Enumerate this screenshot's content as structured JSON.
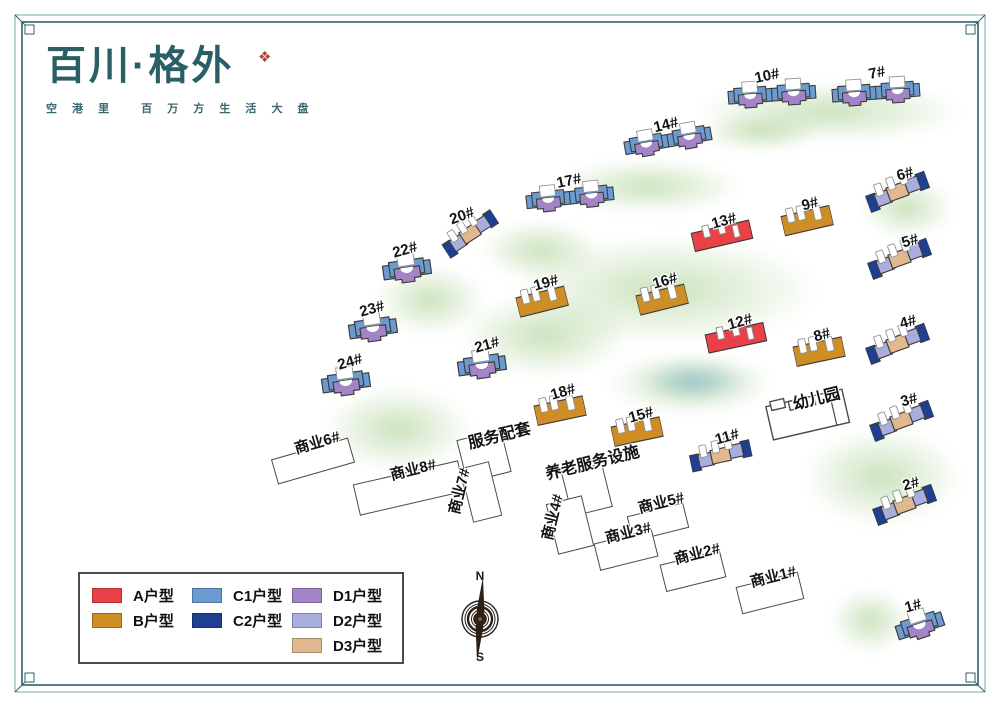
{
  "page": {
    "frame_outer": "#74a5a4",
    "frame_inner": "#2f6068"
  },
  "logo": {
    "title": "百川·格外",
    "seal_glyph": "❖",
    "tagline": "空 港 里　 百 万 方 生 活 大 盘"
  },
  "colors": {
    "A": "#ea4147",
    "B": "#ce8e25",
    "C1": "#6c9bd2",
    "C2": "#1e3f92",
    "D1": "#a385c7",
    "D2": "#a9aede",
    "D3": "#e2b88e"
  },
  "legend": {
    "items": [
      {
        "key": "A",
        "label": "A户型"
      },
      {
        "key": "B",
        "label": "B户型"
      },
      {
        "key": "C1",
        "label": "C1户型"
      },
      {
        "key": "C2",
        "label": "C2户型"
      },
      {
        "key": "D1",
        "label": "D1户型"
      },
      {
        "key": "D2",
        "label": "D2户型"
      },
      {
        "key": "D3",
        "label": "D3户型"
      }
    ],
    "columns": [
      [
        0,
        1
      ],
      [
        2,
        3
      ],
      [
        4,
        5,
        6
      ]
    ]
  },
  "compass": {
    "north": "N",
    "south": "S"
  },
  "blob_colors": {
    "g": "rgba(151,199,123,0.5)",
    "b": "rgba(125,180,205,0.6)"
  },
  "blobs": [
    {
      "x": 830,
      "y": 112,
      "w": 270,
      "h": 60,
      "c": "g"
    },
    {
      "x": 760,
      "y": 132,
      "w": 120,
      "h": 40,
      "c": "g"
    },
    {
      "x": 648,
      "y": 186,
      "w": 190,
      "h": 55,
      "c": "g"
    },
    {
      "x": 906,
      "y": 208,
      "w": 95,
      "h": 60,
      "c": "g"
    },
    {
      "x": 665,
      "y": 290,
      "w": 310,
      "h": 110,
      "c": "g"
    },
    {
      "x": 540,
      "y": 250,
      "w": 120,
      "h": 60,
      "c": "g"
    },
    {
      "x": 545,
      "y": 335,
      "w": 170,
      "h": 85,
      "c": "g"
    },
    {
      "x": 430,
      "y": 300,
      "w": 110,
      "h": 70,
      "c": "g"
    },
    {
      "x": 398,
      "y": 428,
      "w": 150,
      "h": 85,
      "c": "g"
    },
    {
      "x": 690,
      "y": 383,
      "w": 170,
      "h": 65,
      "c": "g"
    },
    {
      "x": 695,
      "y": 381,
      "w": 110,
      "h": 42,
      "c": "b"
    },
    {
      "x": 882,
      "y": 477,
      "w": 160,
      "h": 100,
      "c": "g"
    },
    {
      "x": 870,
      "y": 620,
      "w": 80,
      "h": 65,
      "c": "g"
    }
  ],
  "buildings": [
    {
      "id": "10",
      "t": "double",
      "x": 772,
      "y": 95,
      "r": -4,
      "lbl": {
        "t": "10#",
        "x": 767,
        "y": 76,
        "r": -12
      }
    },
    {
      "id": "7",
      "t": "double",
      "x": 876,
      "y": 93,
      "r": -4,
      "lbl": {
        "t": "7#",
        "x": 877,
        "y": 73,
        "r": -12
      }
    },
    {
      "id": "14",
      "t": "double",
      "x": 668,
      "y": 141,
      "r": -10,
      "lbl": {
        "t": "14#",
        "x": 666,
        "y": 125,
        "r": -14
      }
    },
    {
      "id": "17",
      "t": "double",
      "x": 570,
      "y": 198,
      "r": -6,
      "lbl": {
        "t": "17#",
        "x": 569,
        "y": 181,
        "r": -12
      }
    },
    {
      "id": "20",
      "t": "slabC",
      "x": 471,
      "y": 235,
      "r": -33,
      "w": 60,
      "h": 30,
      "lbl": {
        "t": "20#",
        "x": 462,
        "y": 216,
        "r": -20
      }
    },
    {
      "id": "22",
      "t": "unit",
      "x": 407,
      "y": 270,
      "r": -8,
      "lbl": {
        "t": "22#",
        "x": 405,
        "y": 250,
        "r": -16
      }
    },
    {
      "id": "23",
      "t": "unit",
      "x": 373,
      "y": 329,
      "r": -8,
      "lbl": {
        "t": "23#",
        "x": 372,
        "y": 309,
        "r": -16
      }
    },
    {
      "id": "24",
      "t": "unit",
      "x": 346,
      "y": 383,
      "r": -8,
      "lbl": {
        "t": "24#",
        "x": 350,
        "y": 362,
        "r": -16
      }
    },
    {
      "id": "21",
      "t": "unit",
      "x": 482,
      "y": 366,
      "r": -8,
      "lbl": {
        "t": "21#",
        "x": 487,
        "y": 345,
        "r": -16
      }
    },
    {
      "id": "19",
      "t": "slabB",
      "x": 542,
      "y": 301,
      "r": -14,
      "lbl": {
        "t": "19#",
        "x": 546,
        "y": 283,
        "r": -16
      }
    },
    {
      "id": "16",
      "t": "slabB",
      "x": 662,
      "y": 299,
      "r": -14,
      "lbl": {
        "t": "16#",
        "x": 665,
        "y": 281,
        "r": -16
      }
    },
    {
      "id": "13",
      "t": "slabA",
      "x": 722,
      "y": 236,
      "r": -13,
      "lbl": {
        "t": "13#",
        "x": 724,
        "y": 221,
        "r": -16
      }
    },
    {
      "id": "9",
      "t": "slabB",
      "x": 807,
      "y": 220,
      "r": -13,
      "lbl": {
        "t": "9#",
        "x": 810,
        "y": 204,
        "r": -16
      }
    },
    {
      "id": "12",
      "t": "slabA",
      "x": 736,
      "y": 338,
      "r": -12,
      "lbl": {
        "t": "12#",
        "x": 740,
        "y": 322,
        "r": -16
      }
    },
    {
      "id": "8",
      "t": "slabB",
      "x": 819,
      "y": 351,
      "r": -12,
      "lbl": {
        "t": "8#",
        "x": 822,
        "y": 335,
        "r": -16
      }
    },
    {
      "id": "18",
      "t": "slabB",
      "x": 560,
      "y": 410,
      "r": -12,
      "lbl": {
        "t": "18#",
        "x": 563,
        "y": 392,
        "r": -16
      }
    },
    {
      "id": "15",
      "t": "slabB",
      "x": 637,
      "y": 431,
      "r": -12,
      "lbl": {
        "t": "15#",
        "x": 641,
        "y": 415,
        "r": -16
      }
    },
    {
      "id": "11",
      "t": "slabC",
      "x": 721,
      "y": 457,
      "r": -12,
      "w": 62,
      "h": 32,
      "lbl": {
        "t": "11#",
        "x": 727,
        "y": 437,
        "r": -16
      }
    },
    {
      "id": "6",
      "t": "slabC",
      "x": 898,
      "y": 193,
      "r": -20,
      "lbl": {
        "t": "6#",
        "x": 905,
        "y": 174,
        "r": -16
      }
    },
    {
      "id": "5",
      "t": "slabC",
      "x": 900,
      "y": 260,
      "r": -20,
      "lbl": {
        "t": "5#",
        "x": 910,
        "y": 241,
        "r": -16
      }
    },
    {
      "id": "4",
      "t": "slabC",
      "x": 898,
      "y": 345,
      "r": -20,
      "lbl": {
        "t": "4#",
        "x": 908,
        "y": 322,
        "r": -16
      }
    },
    {
      "id": "3",
      "t": "slabC",
      "x": 902,
      "y": 422,
      "r": -20,
      "lbl": {
        "t": "3#",
        "x": 909,
        "y": 400,
        "r": -16
      }
    },
    {
      "id": "2",
      "t": "slabC",
      "x": 905,
      "y": 506,
      "r": -20,
      "lbl": {
        "t": "2#",
        "x": 911,
        "y": 484,
        "r": -16
      }
    },
    {
      "id": "1",
      "t": "unit",
      "x": 920,
      "y": 626,
      "r": -18,
      "lbl": {
        "t": "1#",
        "x": 913,
        "y": 606,
        "r": -16
      }
    },
    {
      "id": "kg",
      "t": "kg",
      "x": 808,
      "y": 416,
      "r": -13,
      "lbl": {
        "t": "幼儿园",
        "x": 816,
        "y": 397,
        "r": -14,
        "big": true
      }
    },
    {
      "id": "sy6",
      "t": "white",
      "w": 80,
      "h": 26,
      "x": 313,
      "y": 461,
      "r": -16,
      "lbl": {
        "t": "商业6#",
        "x": 317,
        "y": 442,
        "r": -16
      }
    },
    {
      "id": "sy8",
      "t": "white",
      "w": 108,
      "h": 32,
      "x": 409,
      "y": 488,
      "r": -13,
      "lbl": {
        "t": "商业8#",
        "x": 413,
        "y": 469,
        "r": -14
      }
    },
    {
      "id": "fwpt",
      "t": "white",
      "w": 46,
      "h": 44,
      "x": 484,
      "y": 456,
      "r": -14,
      "lbl": {
        "t": "服务配套",
        "x": 499,
        "y": 434,
        "r": -14,
        "big": true
      }
    },
    {
      "id": "sy7",
      "t": "white",
      "w": 30,
      "h": 56,
      "x": 481,
      "y": 492,
      "r": -14,
      "lbl": {
        "t": "商业7#",
        "x": 459,
        "y": 491,
        "r": -76
      }
    },
    {
      "id": "ylfw",
      "t": "white",
      "w": 42,
      "h": 45,
      "x": 587,
      "y": 490,
      "r": -14,
      "lbl": {
        "t": "养老服务设施",
        "x": 592,
        "y": 461,
        "r": -14,
        "big": true
      }
    },
    {
      "id": "sy4",
      "t": "white",
      "w": 37,
      "h": 52,
      "x": 570,
      "y": 525,
      "r": -14,
      "lbl": {
        "t": "商业4#",
        "x": 552,
        "y": 517,
        "r": -76
      }
    },
    {
      "id": "sy5",
      "t": "white",
      "w": 58,
      "h": 26,
      "x": 658,
      "y": 522,
      "r": -14,
      "lbl": {
        "t": "商业5#",
        "x": 661,
        "y": 502,
        "r": -14
      }
    },
    {
      "id": "sy3",
      "t": "white",
      "w": 60,
      "h": 28,
      "x": 626,
      "y": 550,
      "r": -14,
      "lbl": {
        "t": "商业3#",
        "x": 628,
        "y": 532,
        "r": -14
      }
    },
    {
      "id": "sy2",
      "t": "white",
      "w": 62,
      "h": 28,
      "x": 693,
      "y": 571,
      "r": -14,
      "lbl": {
        "t": "商业2#",
        "x": 697,
        "y": 553,
        "r": -14
      }
    },
    {
      "id": "sy1",
      "t": "white",
      "w": 64,
      "h": 28,
      "x": 770,
      "y": 593,
      "r": -14,
      "lbl": {
        "t": "商业1#",
        "x": 773,
        "y": 576,
        "r": -14
      }
    }
  ]
}
